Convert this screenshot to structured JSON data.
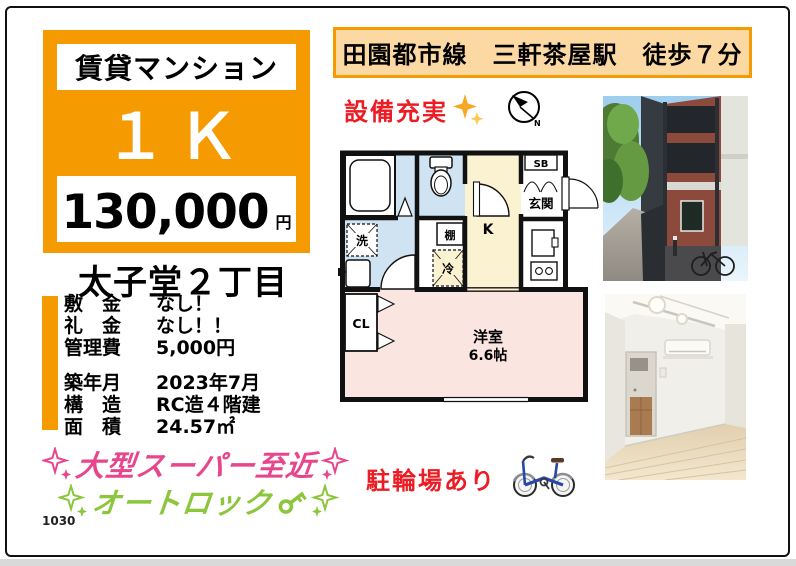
{
  "header": {
    "station_line": "田園都市線　三軒茶屋駅　徒歩７分"
  },
  "price_panel": {
    "category": "賃貸マンション",
    "layout": "１Ｋ",
    "price": "130,000",
    "price_unit": "円"
  },
  "location_title": "太子堂２丁目",
  "details": {
    "rows": [
      {
        "label": "敷　金",
        "value": "なし！"
      },
      {
        "label": "礼　金",
        "value": "なし！！"
      },
      {
        "label": "管理費",
        "value": "5,000円"
      },
      {
        "label": "築年月",
        "value": "2023年7月"
      },
      {
        "label": "構　造",
        "value": "RC造４階建"
      },
      {
        "label": "面　積",
        "value": "24.57㎡"
      }
    ]
  },
  "features": {
    "supermarket": "大型スーパー至近",
    "autolock": "オートロック"
  },
  "badges": {
    "equipment": "設備充実",
    "bicycle_parking": "駐輪場あり"
  },
  "floorplan": {
    "washer": "洗",
    "shelf": "棚",
    "fridge": "冷",
    "kitchen": "K",
    "shoebox": "SB",
    "entrance": "玄関",
    "closet": "CL",
    "room_name": "洋室",
    "room_size": "6.6帖"
  },
  "footer": {
    "code": "1030"
  },
  "colors": {
    "orange": "#F59A00",
    "header_tan": "#FCD9A2",
    "red": "#EC1C24",
    "pink": "#E8468C",
    "green": "#8CC63C",
    "plan_blue": "#CFE3F3",
    "plan_cream": "#FBF2D2",
    "plan_pink": "#FBE5E1"
  }
}
